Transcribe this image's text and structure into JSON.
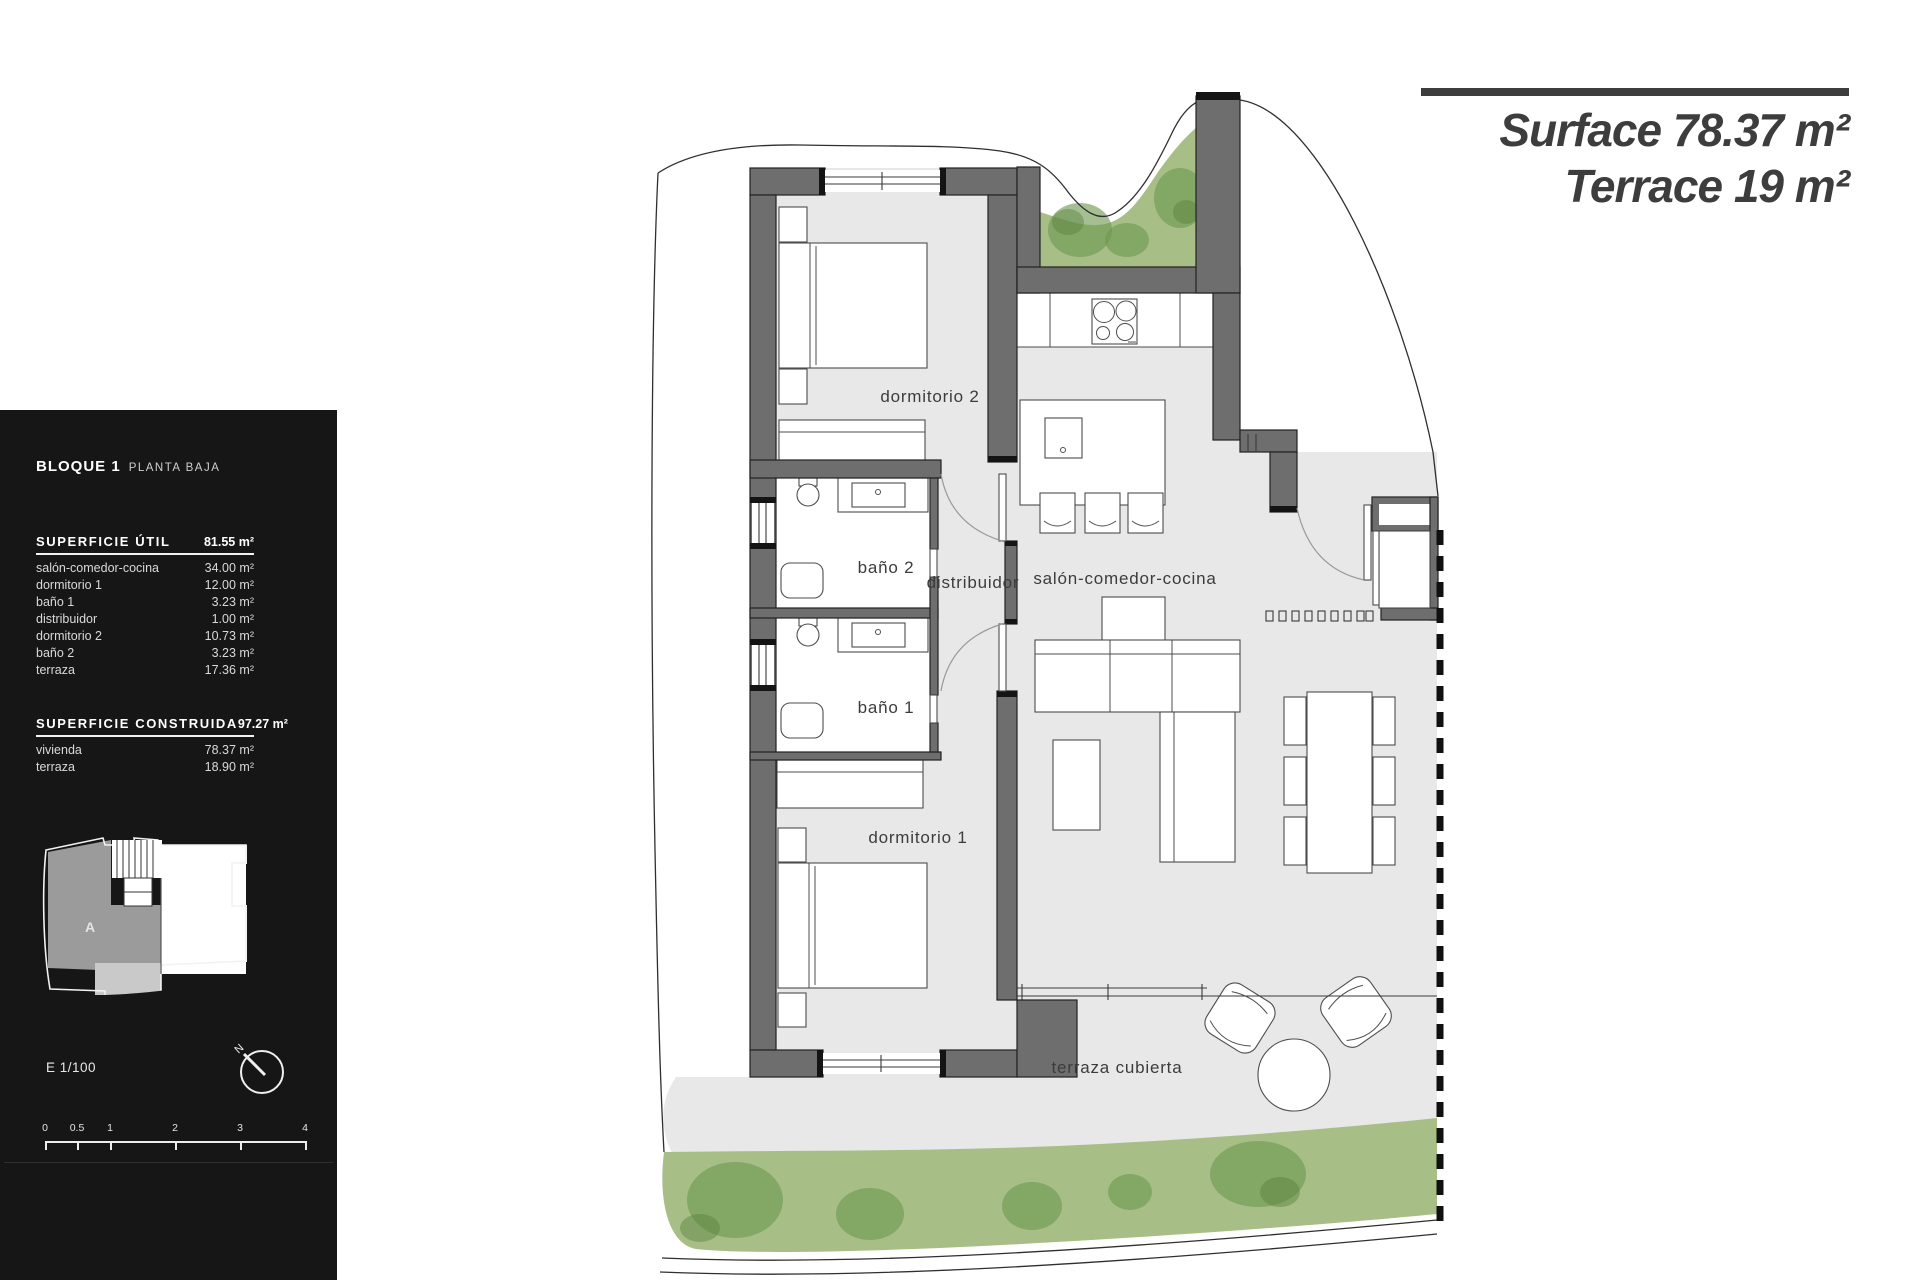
{
  "title_block": {
    "line1_label": "Surface",
    "line1_value": "78.37 m²",
    "line2_label": "Terrace",
    "line2_value": "19 m²"
  },
  "panel": {
    "block_title": "BLOQUE 1",
    "block_subtitle": "PLANTA BAJA",
    "util": {
      "header": "SUPERFICIE ÚTIL",
      "total": "81.55 m²",
      "rows": [
        {
          "label": "salón-comedor-cocina",
          "value": "34.00 m²"
        },
        {
          "label": "dormitorio 1",
          "value": "12.00 m²"
        },
        {
          "label": "baño 1",
          "value": "3.23 m²"
        },
        {
          "label": "distribuidor",
          "value": "1.00 m²"
        },
        {
          "label": "dormitorio 2",
          "value": "10.73 m²"
        },
        {
          "label": "baño 2",
          "value": "3.23 m²"
        },
        {
          "label": "terraza",
          "value": "17.36 m²"
        }
      ]
    },
    "construida": {
      "header": "SUPERFICIE CONSTRUIDA",
      "total": "97.27 m²",
      "rows": [
        {
          "label": "vivienda",
          "value": "78.37 m²"
        },
        {
          "label": "terraza",
          "value": "18.90 m²"
        }
      ]
    },
    "keyplan_unit": "A",
    "scale_text": "E 1/100",
    "compass_label": "N",
    "scalebar_ticks": [
      "0",
      "0.5",
      "1",
      "2",
      "3",
      "4"
    ]
  },
  "plan": {
    "labels": [
      {
        "id": "dormitorio-2",
        "text": "dormitorio 2"
      },
      {
        "id": "bano-2",
        "text": "baño 2"
      },
      {
        "id": "distribuidor",
        "text": "distribuidor"
      },
      {
        "id": "salon-comedor-cocina",
        "text": "salón-comedor-cocina"
      },
      {
        "id": "bano-1",
        "text": "baño 1"
      },
      {
        "id": "dormitorio-1",
        "text": "dormitorio 1"
      },
      {
        "id": "terraza-cubierta",
        "text": "terraza cubierta"
      }
    ]
  },
  "colors": {
    "panel_bg": "#161616",
    "ink": "#3d3d3d",
    "wall": "#6e6e6e",
    "floor": "#e8e8e9",
    "garden": "#a7bf87",
    "garden_dark": "#6d9751"
  }
}
